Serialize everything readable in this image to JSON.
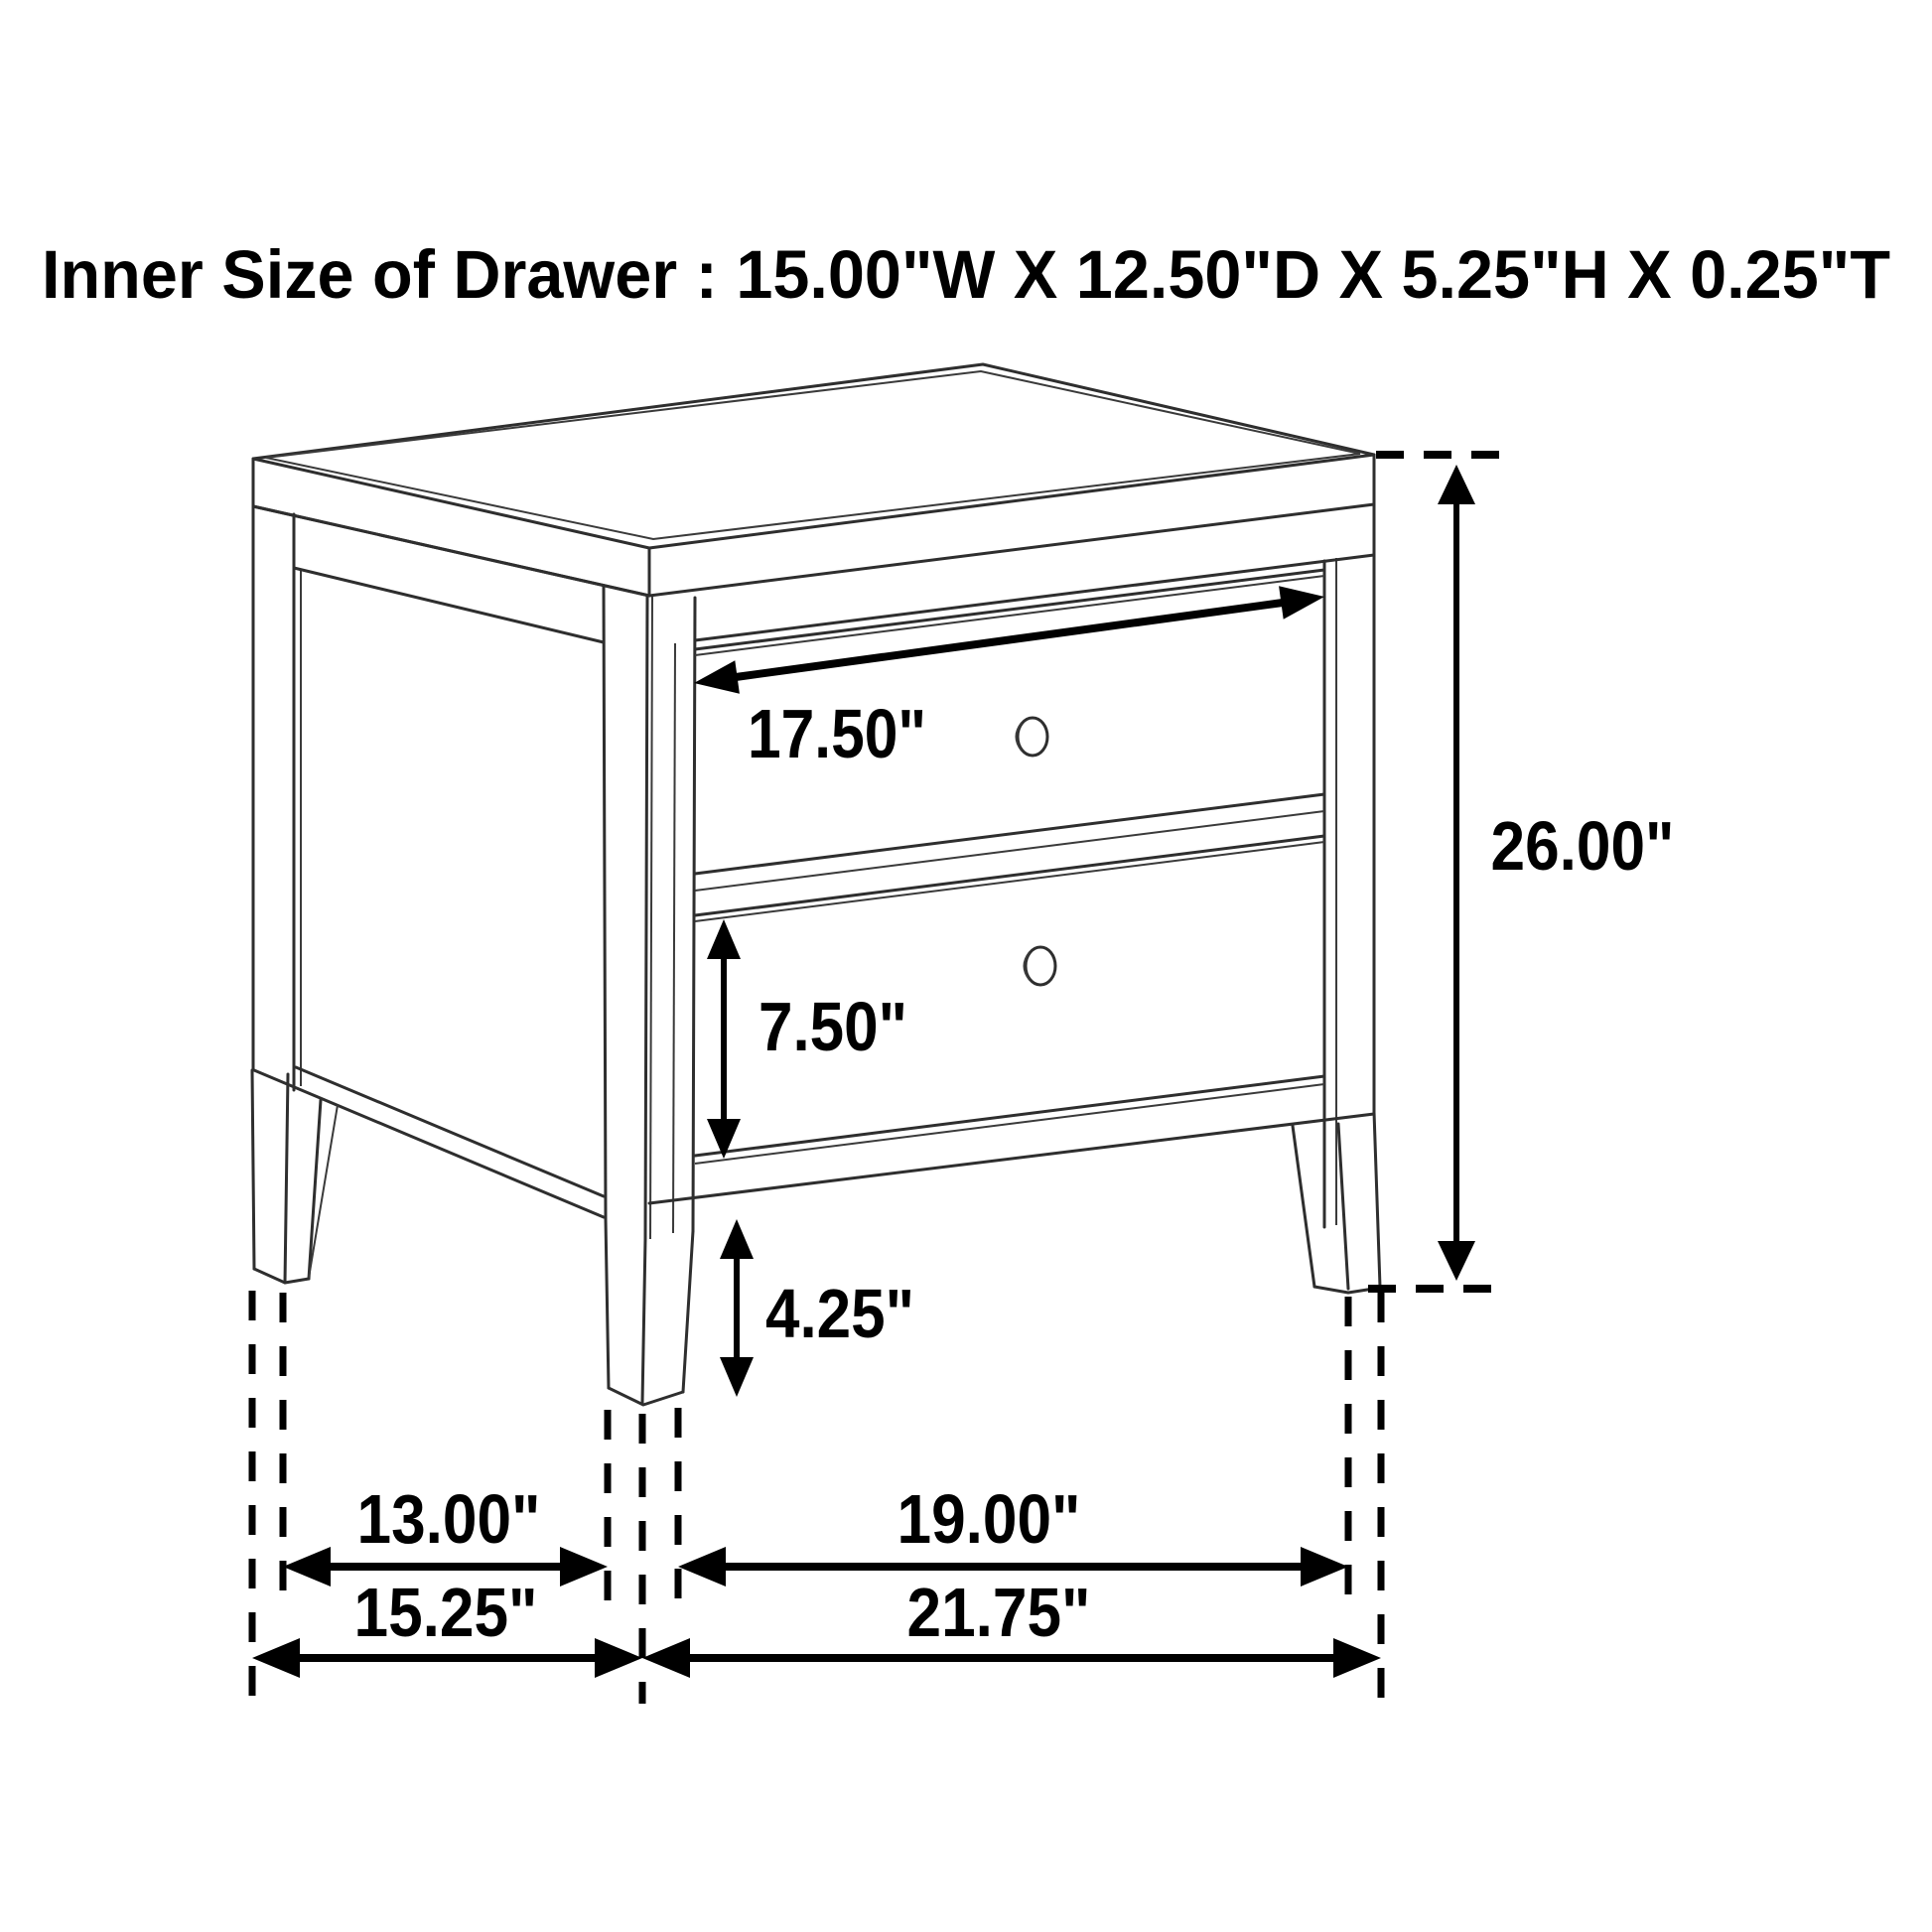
{
  "page": {
    "background_color": "#ffffff",
    "ink_color": "#000000",
    "line_color": "#2e2e2e"
  },
  "title": {
    "text": "Inner Size of Drawer : 15.00\"W X 12.50\"D X 5.25\"H X 0.25\"T"
  },
  "diagram": {
    "subject": "two-drawer nightstand isometric line drawing with dimension callouts",
    "labels": {
      "drawer_width": "17.50\"",
      "drawer_front_height": "7.50\"",
      "leg_height": "4.25\"",
      "overall_height": "26.00\"",
      "side_leg_span": "13.00\"",
      "overall_depth": "15.25\"",
      "front_leg_span": "19.00\"",
      "overall_width": "21.75\""
    },
    "inner_drawer_size": {
      "width": "15.00\"",
      "depth": "12.50\"",
      "height": "5.25\"",
      "thickness": "0.25\""
    }
  }
}
